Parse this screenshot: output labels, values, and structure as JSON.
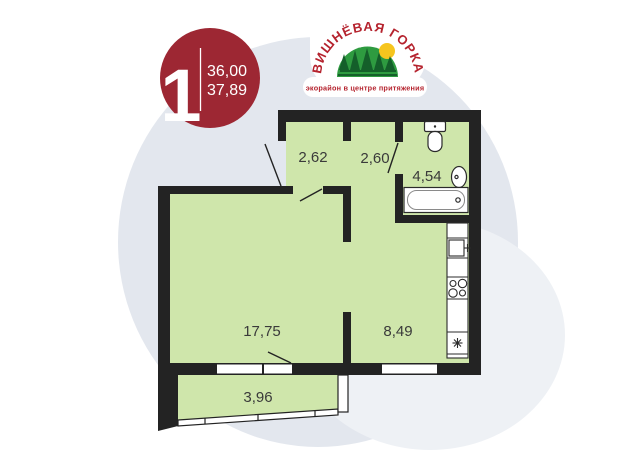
{
  "card": {
    "badge": {
      "rooms_count": "1",
      "area_value_1": "36,00",
      "area_value_2": "37,89"
    },
    "logo": {
      "name": "ВИШНЁВАЯ ГОРКА",
      "tagline": "экорайон в центре притяжения"
    },
    "plan": {
      "rooms": [
        {
          "id": "hallway",
          "area": "2,62"
        },
        {
          "id": "corridor",
          "area": "2,60"
        },
        {
          "id": "bathroom",
          "area": "4,54"
        },
        {
          "id": "living-room",
          "area": "17,75"
        },
        {
          "id": "kitchen",
          "area": "8,49"
        },
        {
          "id": "balcony",
          "area": "3,96"
        }
      ]
    },
    "colors": {
      "badge_red": "#9d2733",
      "floor_green": "#cfe6ab",
      "wall_dark": "#232323",
      "bg_circle": "#e3e7ee",
      "bg_circle_light": "#eef1f5",
      "logo_green": "#2e9b40",
      "logo_tree_green": "#145f2a",
      "logo_red": "#b5232e",
      "sun_yellow": "#f6c51e"
    }
  }
}
